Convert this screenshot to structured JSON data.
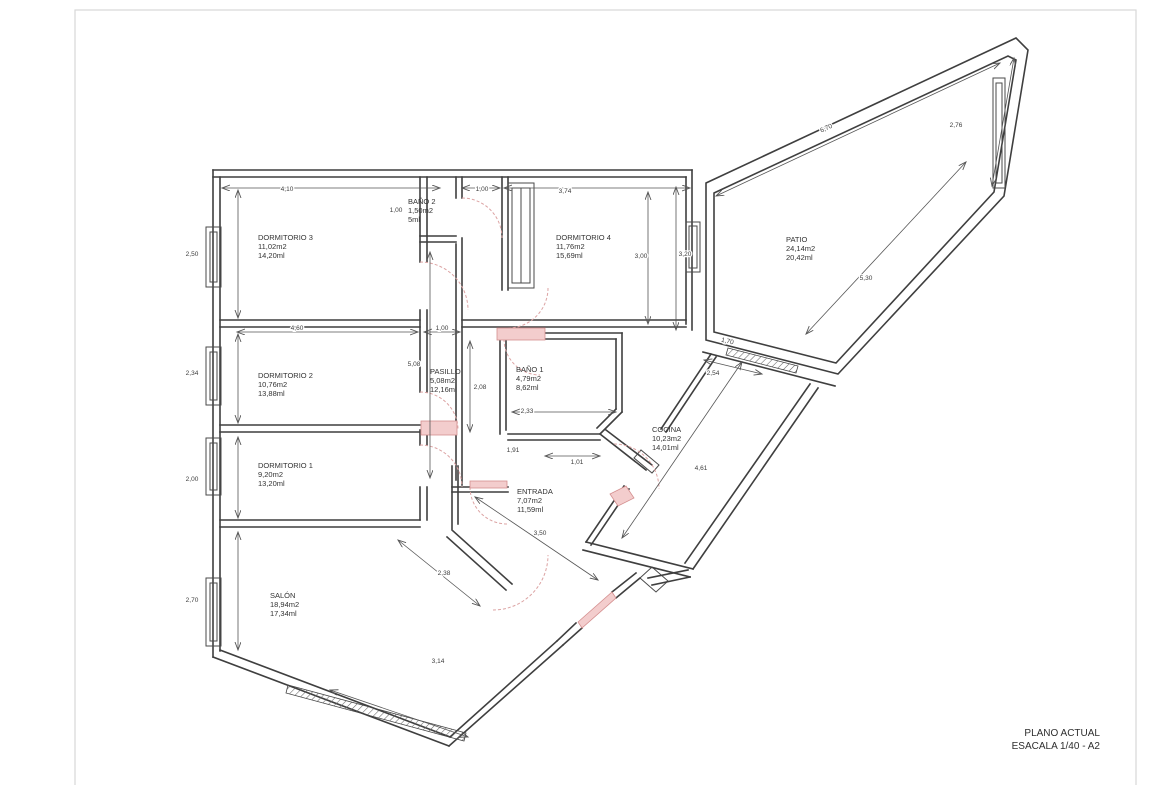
{
  "title_block": {
    "line1": "PLANO ACTUAL",
    "line2": "ESACALA 1/40 - A2"
  },
  "colors": {
    "wall": "#3f3f3f",
    "door_arc": "#dca3a3",
    "threshold": "#f3cdcd",
    "dimension": "#555555",
    "sheet_border": "#d7d7d7",
    "background": "#ffffff"
  },
  "rooms": [
    {
      "id": "dormitorio-3",
      "name": "DORMITORIO 3",
      "area": "11,02m2",
      "perimeter": "14,20ml",
      "x": 258,
      "y": 240
    },
    {
      "id": "bano-2",
      "name": "BAÑO 2",
      "area": "1,50m2",
      "perimeter": "5ml",
      "x": 408,
      "y": 204
    },
    {
      "id": "dormitorio-4",
      "name": "DORMITORIO 4",
      "area": "11,76m2",
      "perimeter": "15,69ml",
      "x": 556,
      "y": 240
    },
    {
      "id": "patio",
      "name": "PATIO",
      "area": "24,14m2",
      "perimeter": "20,42ml",
      "x": 786,
      "y": 242
    },
    {
      "id": "dormitorio-2",
      "name": "DORMITORIO 2",
      "area": "10,76m2",
      "perimeter": "13,88ml",
      "x": 258,
      "y": 378
    },
    {
      "id": "pasillo",
      "name": "PASILLO",
      "area": "5,08m2",
      "perimeter": "12,16ml",
      "x": 430,
      "y": 374
    },
    {
      "id": "bano-1",
      "name": "BAÑO 1",
      "area": "4,79m2",
      "perimeter": "8,62ml",
      "x": 516,
      "y": 372
    },
    {
      "id": "dormitorio-1",
      "name": "DORMITORIO 1",
      "area": "9,20m2",
      "perimeter": "13,20ml",
      "x": 258,
      "y": 468
    },
    {
      "id": "entrada",
      "name": "ENTRADA",
      "area": "7,07m2",
      "perimeter": "11,59ml",
      "x": 517,
      "y": 494
    },
    {
      "id": "cocina",
      "name": "COCINA",
      "area": "10,23m2",
      "perimeter": "14,01ml",
      "x": 652,
      "y": 432
    },
    {
      "id": "salon",
      "name": "SALÓN",
      "area": "18,94m2",
      "perimeter": "17,34ml",
      "x": 270,
      "y": 598
    }
  ],
  "dimensions": [
    {
      "label": "2,50",
      "x": 192,
      "y": 256,
      "rot": 0
    },
    {
      "label": "2,34",
      "x": 192,
      "y": 375,
      "rot": 0
    },
    {
      "label": "2,00",
      "x": 192,
      "y": 481,
      "rot": 0
    },
    {
      "label": "2,70",
      "x": 192,
      "y": 602,
      "rot": 0
    },
    {
      "label": "4,10",
      "x": 287,
      "y": 191,
      "rot": 0
    },
    {
      "label": "1,00",
      "x": 482,
      "y": 191,
      "rot": 0
    },
    {
      "label": "3,74",
      "x": 565,
      "y": 193,
      "rot": 0
    },
    {
      "label": "6,70",
      "x": 827,
      "y": 130,
      "rot": -25
    },
    {
      "label": "2,76",
      "x": 956,
      "y": 127,
      "rot": 0
    },
    {
      "label": "3,00",
      "x": 641,
      "y": 258,
      "rot": 0
    },
    {
      "label": "3,20",
      "x": 685,
      "y": 256,
      "rot": 0
    },
    {
      "label": "5,30",
      "x": 866,
      "y": 280,
      "rot": 0
    },
    {
      "label": "1,00",
      "x": 396,
      "y": 212,
      "rot": 0
    },
    {
      "label": "4,60",
      "x": 297,
      "y": 330,
      "rot": 0
    },
    {
      "label": "1,00",
      "x": 442,
      "y": 330,
      "rot": 0
    },
    {
      "label": "5,08",
      "x": 414,
      "y": 366,
      "rot": 0
    },
    {
      "label": "2,08",
      "x": 480,
      "y": 389,
      "rot": 0
    },
    {
      "label": "2,54",
      "x": 713,
      "y": 375,
      "rot": 0
    },
    {
      "label": "2,33",
      "x": 527,
      "y": 413,
      "rot": 0
    },
    {
      "label": "1,91",
      "x": 513,
      "y": 452,
      "rot": 0
    },
    {
      "label": "1,01",
      "x": 577,
      "y": 464,
      "rot": 0
    },
    {
      "label": "4,61",
      "x": 701,
      "y": 470,
      "rot": 0
    },
    {
      "label": "3,50",
      "x": 540,
      "y": 535,
      "rot": 0
    },
    {
      "label": "2,38",
      "x": 444,
      "y": 575,
      "rot": 0
    },
    {
      "label": "3,14",
      "x": 438,
      "y": 663,
      "rot": 0
    },
    {
      "label": "1,70",
      "x": 727,
      "y": 343,
      "rot": 13
    }
  ]
}
